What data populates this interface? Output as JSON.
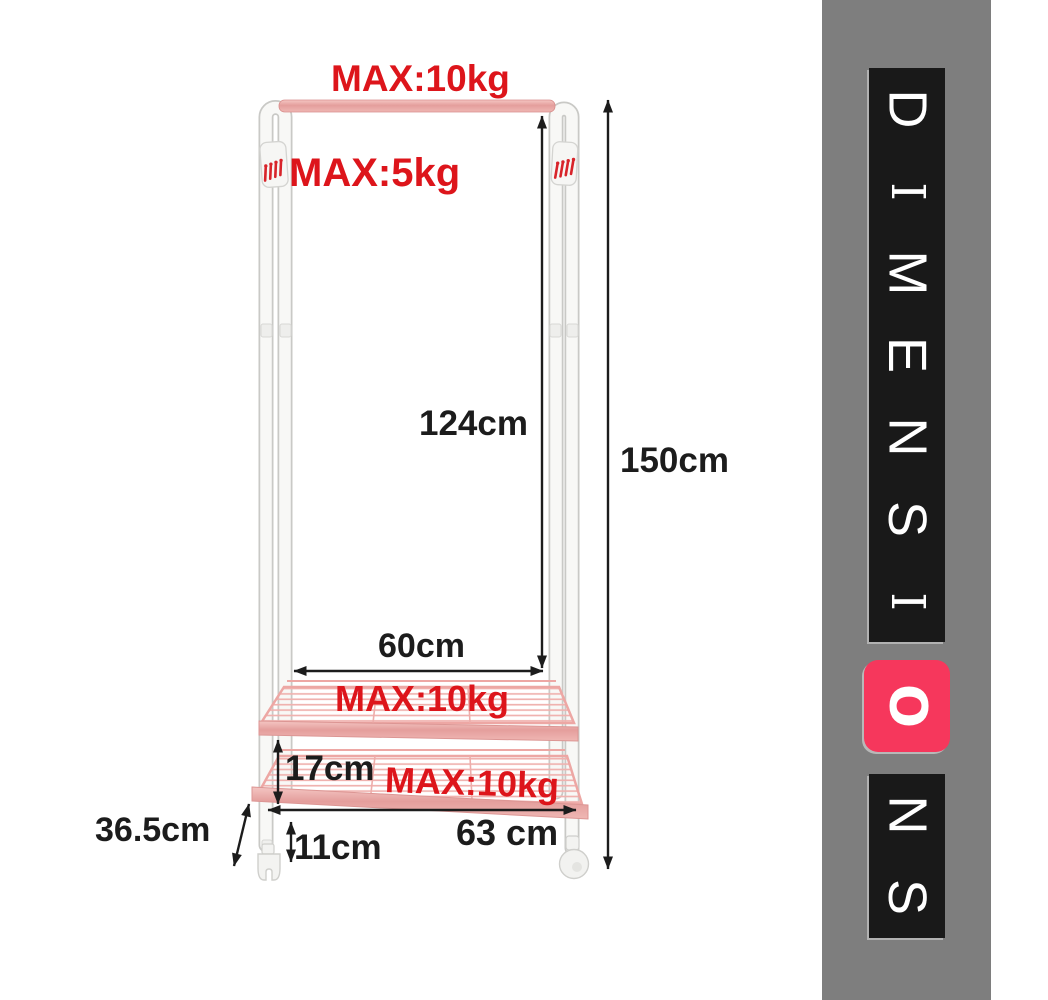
{
  "figure": {
    "weight_limits": {
      "hanging_bar": "MAX:10kg",
      "side_hooks": "MAX:5kg",
      "middle_shelf": "MAX:10kg",
      "bottom_shelf": "MAX:10kg"
    },
    "measurements": {
      "bar_to_shelf_height": "124cm",
      "total_height": "150cm",
      "shelf_width": "60cm",
      "shelf_spacing": "17cm",
      "base_width": "63 cm",
      "base_clearance": "11cm",
      "depth": "36.5cm"
    }
  },
  "sidebar": {
    "word": "DIMENSIONS",
    "letters": [
      "D",
      "I",
      "M",
      "E",
      "N",
      "S",
      "I",
      "O",
      "N",
      "S"
    ],
    "accent_letter": "O",
    "accent_letter_index": 7
  },
  "colors": {
    "warning_red": "#dd151b",
    "shelf_pink": "#f0b2af",
    "bar_pink": "#e49e9c",
    "banner_gray": "#7e7e7e",
    "tile_black": "#191919",
    "tile_accent_pink": "#f6375c",
    "dimension_line": "#1c1c1c",
    "frame_white": "#f8f8f6"
  }
}
